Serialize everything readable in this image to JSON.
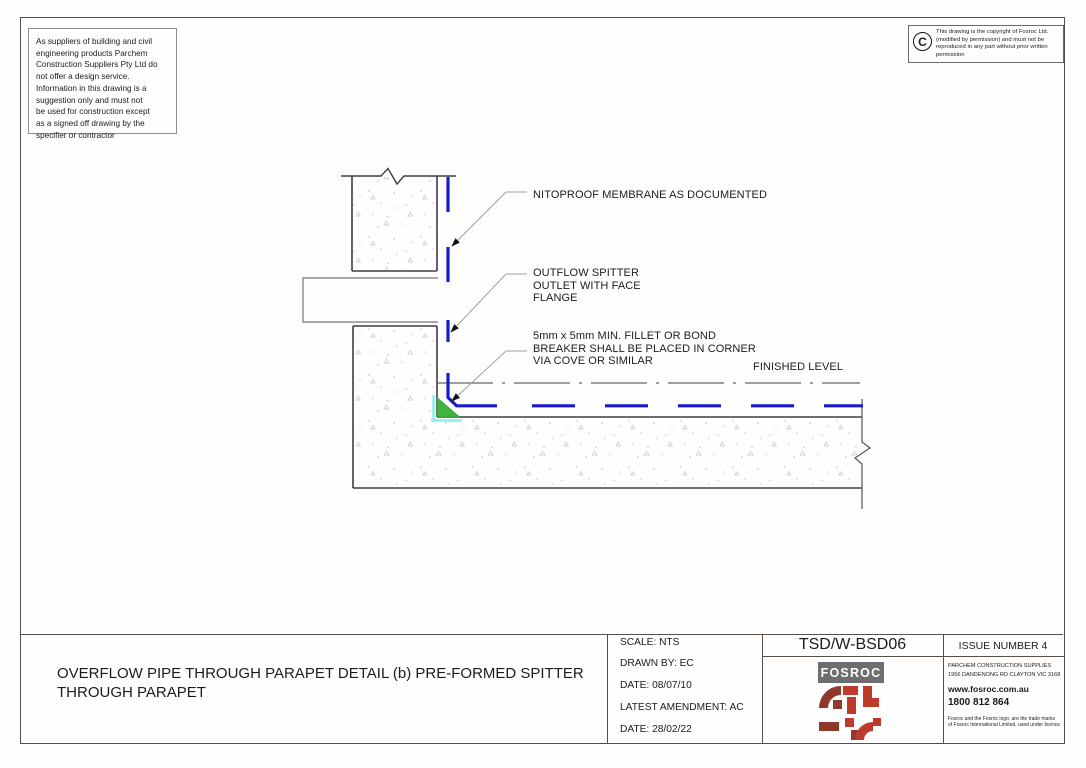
{
  "colors": {
    "membrane": "#1a1ace",
    "fillet": "#3fb43f",
    "highlight": "#86efec",
    "fosroc_red": "#bf3a2b",
    "fosroc_red_dark": "#8e392c",
    "fosroc_gray": "#6d6e70"
  },
  "disclaimer": {
    "text": "As suppliers of building and civil\nengineering products Parchem\nConstruction Suppliers Pty Ltd do\nnot offer a design service.\nInformation in this drawing is a\nsuggestion only and must not\nbe used for construction except\nas a signed off drawing by the\nspecifier or contractor"
  },
  "copyright": {
    "symbol": "C",
    "text": "This drawing is the copyright of Fosroc Ltd. (modified by permission) and must not be reproduced in any part without prior written permission"
  },
  "drawing": {
    "labels": {
      "membrane": "NITOPROOF MEMBRANE AS DOCUMENTED",
      "spitter": "OUTFLOW SPITTER\nOUTLET WITH FACE\nFLANGE",
      "fillet": "5mm x 5mm MIN. FILLET OR BOND\nBREAKER SHALL BE PLACED IN CORNER\nVIA COVE OR SIMILAR",
      "finished_level": "FINISHED LEVEL"
    }
  },
  "title_block": {
    "title": "OVERFLOW PIPE THROUGH PARAPET DETAIL (b) PRE-FORMED SPITTER\nTHROUGH PARAPET",
    "scale": "SCALE: NTS",
    "drawn_by": "DRAWN BY: EC",
    "date_drawn": "DATE: 08/07/10",
    "latest_amendment": "LATEST AMENDMENT: AC",
    "date_amended": "DATE: 28/02/22",
    "drawing_number": "TSD/W-BSD06",
    "issue": "ISSUE NUMBER 4",
    "logo_text": "FOSROC",
    "supplier_name": "PARCHEM CONSTRUCTION SUPPLIES",
    "supplier_address": "1956 DANDENONG RD CLAYTON VIC 3168",
    "website": "www.fosroc.com.au",
    "phone": "1800 812 864",
    "trademark": "Fosroc and the Fosroc logo, are the trade marks of Fosroc International Limited, used under licence"
  }
}
